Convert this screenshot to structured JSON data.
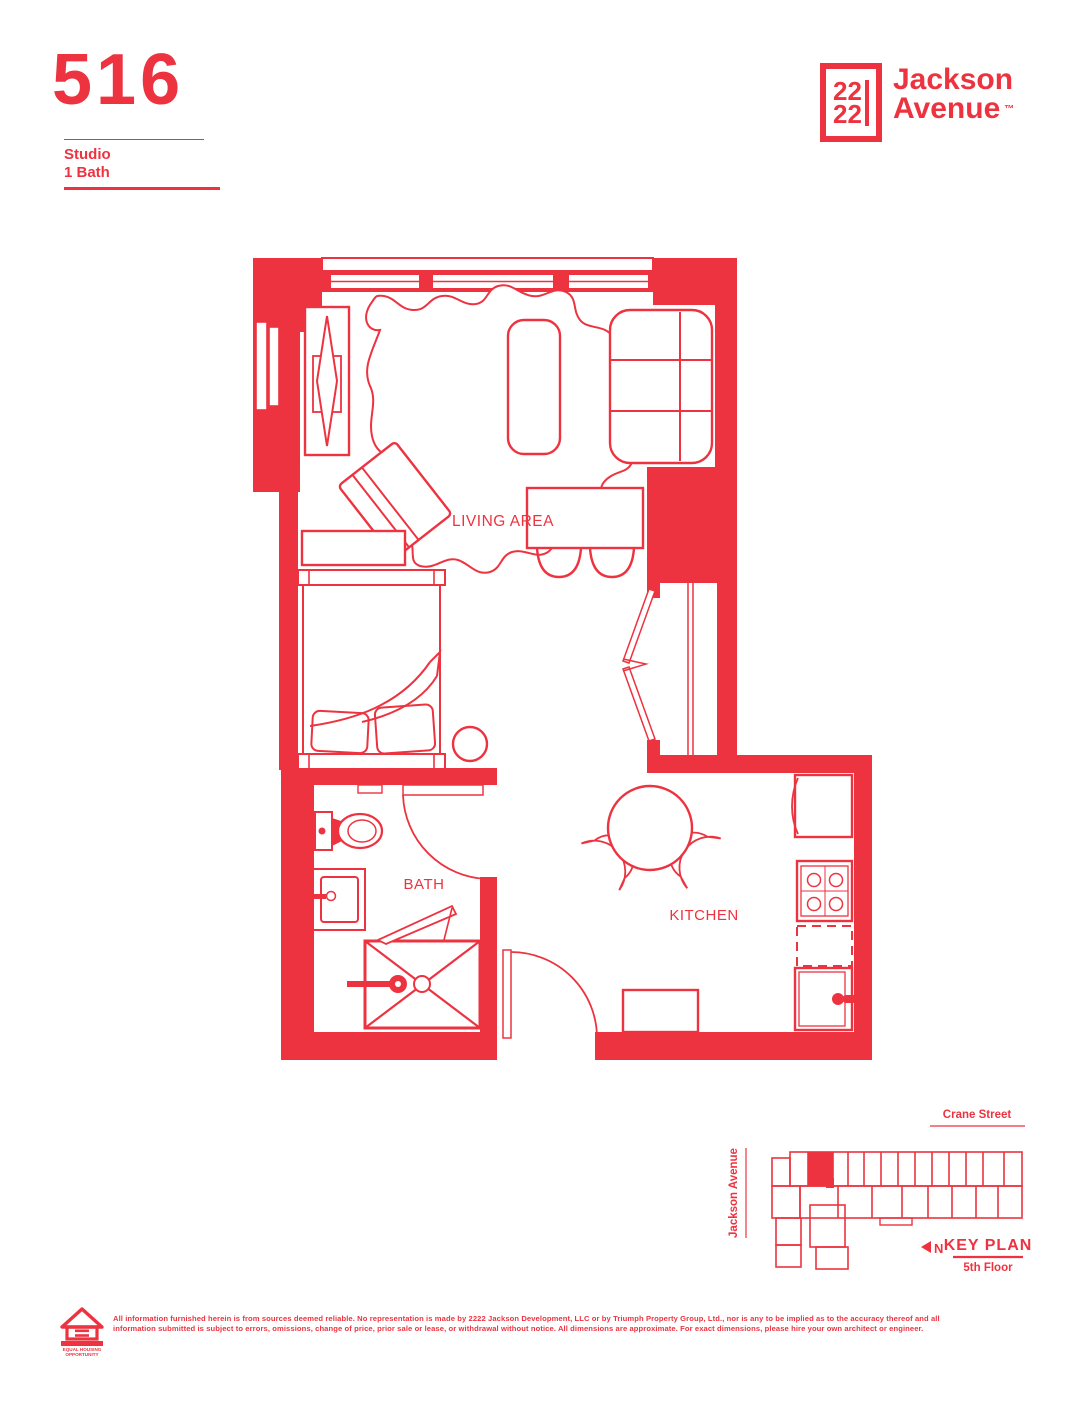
{
  "colors": {
    "red": "#ED3340",
    "background": "#FFFFFF"
  },
  "header": {
    "unit_number": "516",
    "unit_type": "Studio",
    "unit_bath": "1 Bath"
  },
  "logo": {
    "box_line1": "22",
    "box_line2": "22",
    "name1": "Jackson",
    "name2": "Avenue",
    "tm": "™"
  },
  "floorplan": {
    "labels": {
      "living": "LIVING AREA",
      "bath": "BATH",
      "kitchen": "KITCHEN"
    }
  },
  "keyplan": {
    "crane_street": "Crane Street",
    "jackson_avenue": "Jackson Avenue",
    "title": "KEY PLAN",
    "floor": "5th Floor",
    "north": "N"
  },
  "footer": {
    "line1": "All information furnished herein is from sources deemed reliable. No representation is made by 2222 Jackson Development, LLC or by Triumph Property Group, Ltd., nor is any to be implied as to the accuracy thereof and all",
    "line2": "information submitted is subject to errors, omissions, change of price, prior sale or lease, or withdrawal without notice. All dimensions are approximate. For exact dimensions, please hire your own architect or engineer.",
    "eho1": "EQUAL HOUSING",
    "eho2": "OPPORTUNITY"
  }
}
